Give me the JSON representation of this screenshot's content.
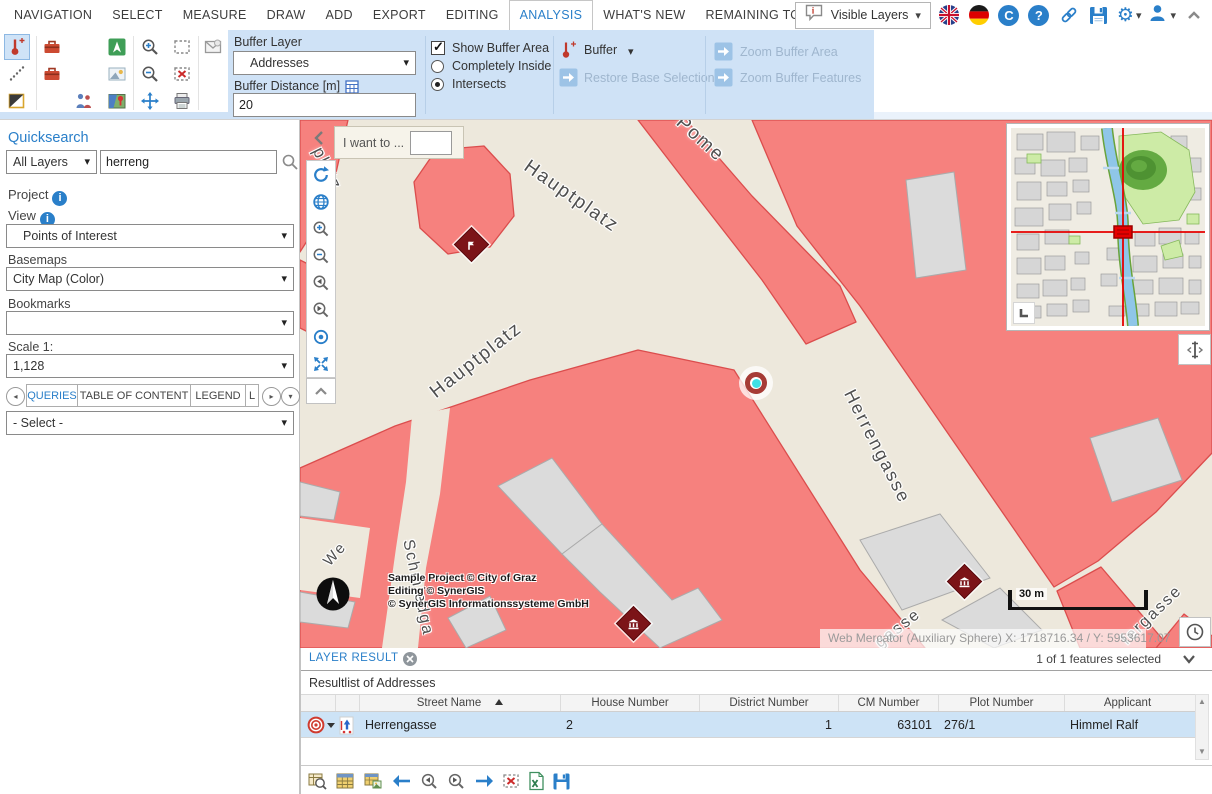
{
  "menubar": {
    "items": [
      "NAVIGATION",
      "SELECT",
      "MEASURE",
      "DRAW",
      "ADD",
      "EXPORT",
      "EDITING",
      "ANALYSIS",
      "WHAT'S NEW",
      "REMAINING TOOLS"
    ],
    "visible_layers_label": "Visible Layers"
  },
  "ribbon": {
    "buffer_layer_label": "Buffer Layer",
    "buffer_layer_value": "Addresses",
    "buffer_distance_label": "Buffer Distance [m]",
    "buffer_distance_value": "20",
    "show_buffer_area_label": "Show Buffer Area",
    "completely_inside_label": "Completely Inside",
    "intersects_label": "Intersects",
    "buffer_button_label": "Buffer",
    "restore_base_selection_label": "Restore Base Selection",
    "zoom_buffer_area_label": "Zoom Buffer Area",
    "zoom_buffer_features_label": "Zoom Buffer Features"
  },
  "sidebar": {
    "quicksearch_label": "Quicksearch",
    "search_scope_value": "All Layers",
    "search_value": "herreng",
    "project_label": "Project",
    "view_label": "View",
    "view_value": "Points of Interest",
    "basemaps_label": "Basemaps",
    "basemap_value": "City Map (Color)",
    "bookmarks_label": "Bookmarks",
    "bookmarks_value": "",
    "scale_label": "Scale 1:",
    "scale_value": "1,128",
    "tab_queries": "QUERIES",
    "tab_toc": "TABLE OF CONTENT",
    "tab_legend": "LEGEND",
    "tab_overflow": "L",
    "query_select_value": "- Select -"
  },
  "map": {
    "i_want_to_label": "I want to ...",
    "labels": {
      "platz": "platz",
      "hauptplatz_top": "Hauptplatz",
      "pome": "Pome",
      "hauptplatz_bottom": "Hauptplatz",
      "herrengasse": "Herrengasse",
      "schmiedgasse": "Schmiedga",
      "we": "We",
      "gasse": "gasse",
      "fergasse": "fergasse"
    },
    "attribution_line1": "Sample Project © City of Graz",
    "attribution_line2": "Editing © SynerGIS",
    "attribution_line3": "© SynerGIS Informationssysteme GmbH",
    "scalebar_label": "30 m",
    "coordinates_text": "Web Mercator (Auxiliary Sphere) X: 1718716.34 / Y: 5953617.07"
  },
  "result_panel": {
    "tab_label": "LAYER RESULT",
    "selection_status": "1 of 1 features selected",
    "list_title": "Resultlist of Addresses",
    "columns": {
      "street": "Street Name",
      "house": "House Number",
      "district": "District Number",
      "cm": "CM Number",
      "plot": "Plot Number",
      "applicant": "Applicant"
    },
    "row": {
      "street": "Herrengasse",
      "house": "2",
      "district": "1",
      "cm": "63101",
      "plot": "276/1",
      "applicant": "Himmel Ralf"
    }
  },
  "colors": {
    "accent_blue": "#2a7fc9",
    "ribbon_panel_blue": "#cfe2f6",
    "selected_row_blue": "#cde3f6",
    "map_street_beige": "#ede8dc",
    "map_building_pink": "#f6817e",
    "map_building_outline": "#db4d4d",
    "poi_marker_dark_red": "#7c1418",
    "overview_crosshair_red": "#e60000"
  }
}
